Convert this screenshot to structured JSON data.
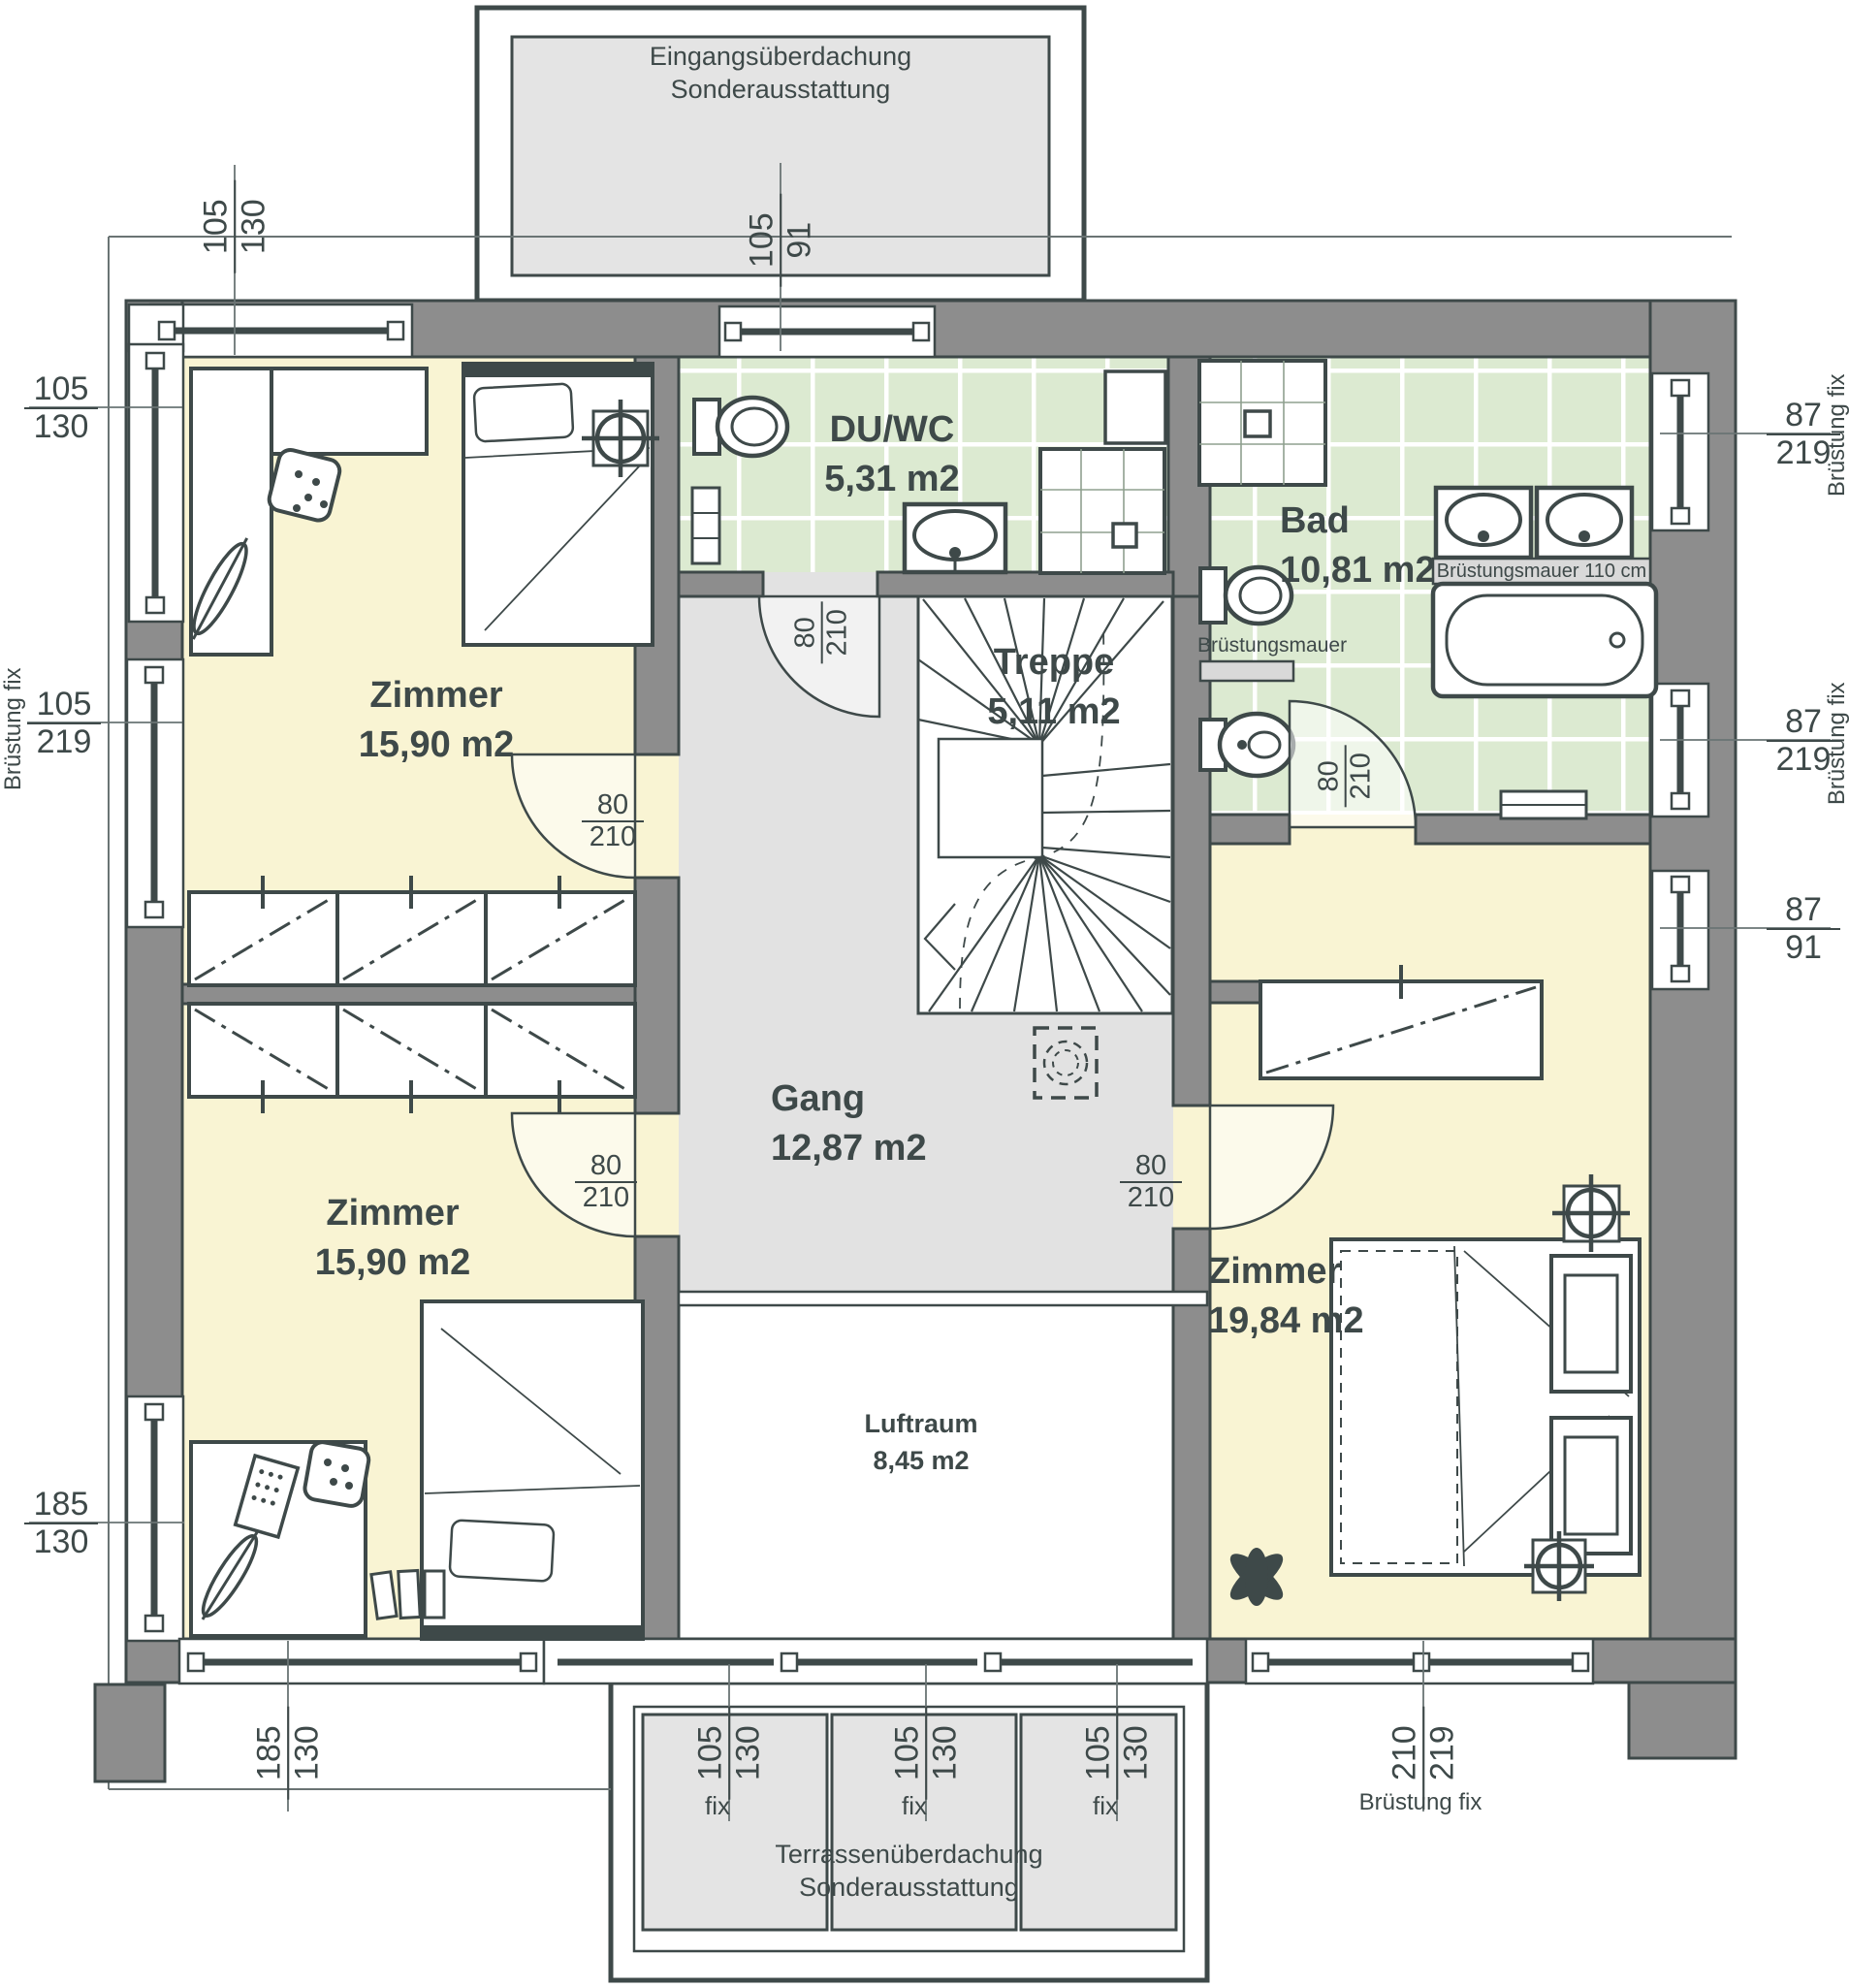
{
  "canopies": {
    "entrance": {
      "line1": "Eingangsüberdachung",
      "line2": "Sonderausstattung"
    },
    "terrace": {
      "line1": "Terrassenüberdachung",
      "line2": "Sonderausstattung"
    }
  },
  "rooms": {
    "zimmer_tl": {
      "name": "Zimmer",
      "area": "15,90 m2"
    },
    "zimmer_bl": {
      "name": "Zimmer",
      "area": "15,90 m2"
    },
    "zimmer_r": {
      "name": "Zimmer",
      "area": "19,84 m2"
    },
    "duwc": {
      "name": "DU/WC",
      "area": "5,31 m2"
    },
    "bad": {
      "name": "Bad",
      "area": "10,81 m2"
    },
    "treppe": {
      "name": "Treppe",
      "area": "5,11 m2"
    },
    "gang": {
      "name": "Gang",
      "area": "12,87 m2"
    },
    "luftraum": {
      "name": "Luftraum",
      "area": "8,45 m2"
    }
  },
  "door": {
    "w": "80",
    "h": "210"
  },
  "windows": {
    "corner_top_left": {
      "w": "105",
      "h": "130"
    },
    "left_upper": {
      "w": "105",
      "h": "130"
    },
    "left_parapet": {
      "w": "105",
      "h": "219"
    },
    "left_lower": {
      "w": "185",
      "h": "130"
    },
    "corner_bottom_left": {
      "w": "185",
      "h": "130"
    },
    "entrance": {
      "w": "105",
      "h": "91"
    },
    "right_bad_upper": {
      "w": "87",
      "h": "219"
    },
    "right_bad_lower": {
      "w": "87",
      "h": "219"
    },
    "right_zimmer": {
      "w": "87",
      "h": "91"
    },
    "bottom_right": {
      "w": "210",
      "h": "219"
    },
    "terrace_1": {
      "w": "105",
      "h": "130"
    },
    "terrace_2": {
      "w": "105",
      "h": "130"
    },
    "terrace_3": {
      "w": "105",
      "h": "130"
    }
  },
  "notes": {
    "bruestung_fix": "Brüstung fix",
    "fix": "fix",
    "parapet": "Brüstungsmauer",
    "parapet_110": "Brüstungsmauer 110 cm"
  },
  "colors": {
    "wall": "#8d8d8d",
    "stroke": "#3e4949",
    "room_yellow": "#f9f4d3",
    "bath_green": "#dcead1",
    "corridor_gray": "#e2e2e2",
    "canopy_gray": "#e4e4e4"
  }
}
